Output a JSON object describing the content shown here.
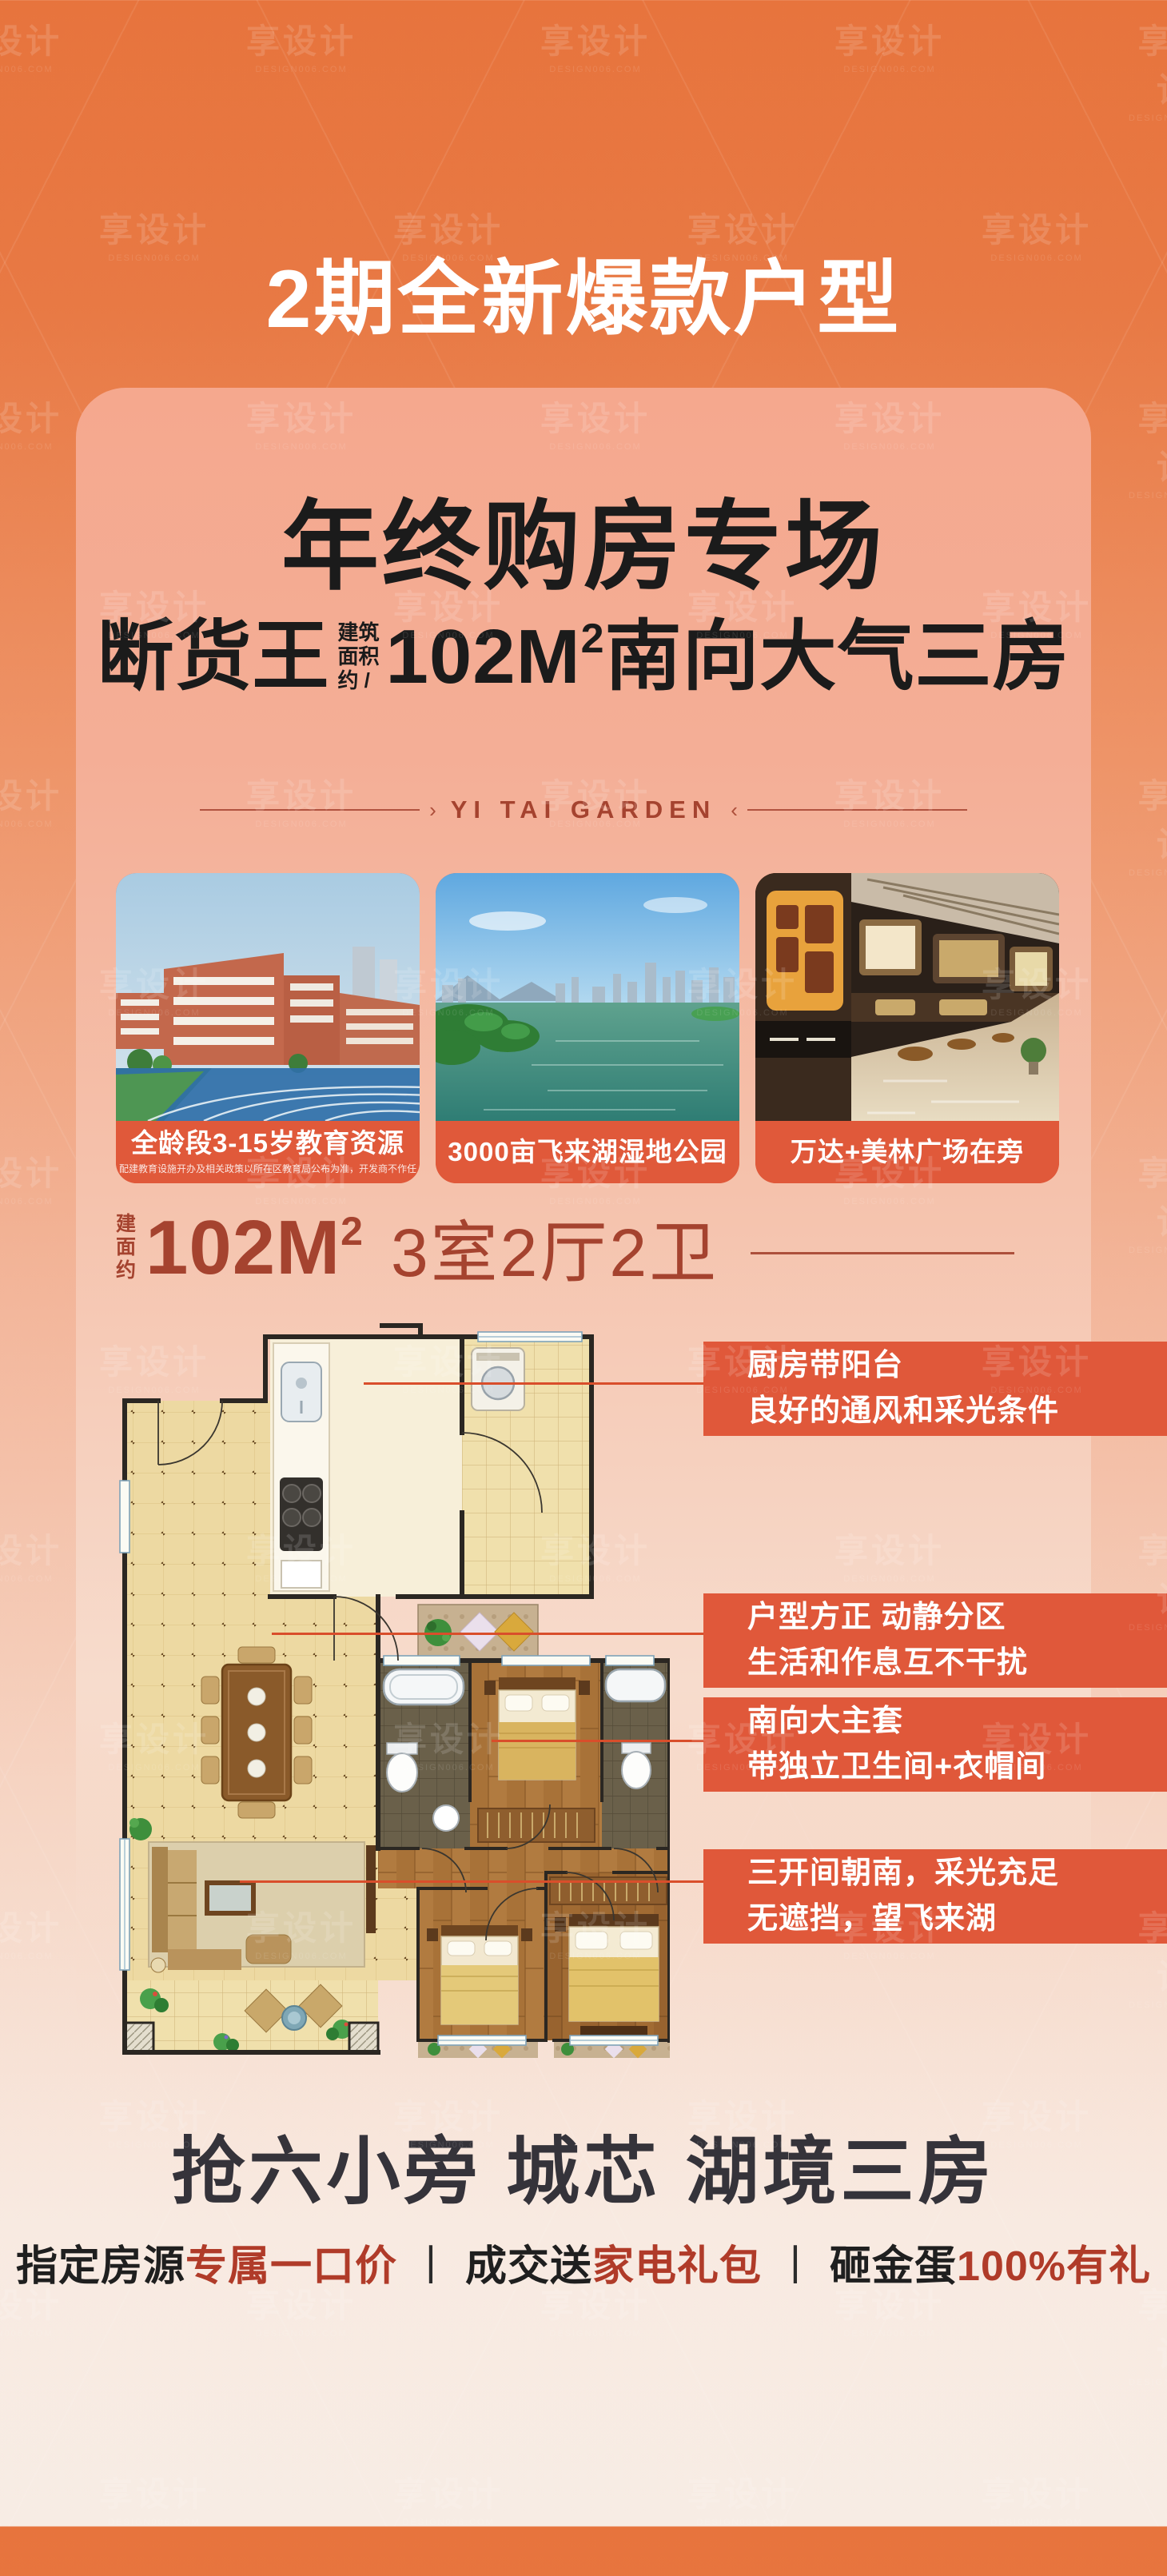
{
  "watermark": {
    "brand": "享设计",
    "site": "DESIGN006.COM"
  },
  "header": {
    "title": "2期全新爆款户型"
  },
  "card": {
    "headline": "年终购房专场",
    "sub": {
      "prefix": "断货王",
      "note1": "建筑",
      "note2": "面积",
      "note3": "约 /",
      "area": "102M",
      "sup": "2",
      "suffix": "南向大气三房"
    },
    "garden": "YI TAI GARDEN",
    "garden_arrow_right": "›",
    "garden_arrow_left": "‹"
  },
  "photos": [
    {
      "caption": "全龄段3-15岁教育资源",
      "note": "配建教育设施开办及相关政策以所在区教育局公布为准，开发商不作任何承诺"
    },
    {
      "caption": "3000亩飞来湖湿地公园"
    },
    {
      "caption": "万达+美林广场在旁"
    }
  ],
  "spec": {
    "l1": "建",
    "l2": "面",
    "l3": "约",
    "area": "102M",
    "sup": "2",
    "rooms": "3室2厅2卫"
  },
  "callouts": [
    {
      "line1": "厨房带阳台",
      "line2": "良好的通风和采光条件"
    },
    {
      "line1": "户型方正 动静分区",
      "line2": "生活和作息互不干扰"
    },
    {
      "line1": "南向大主套",
      "line2": "带独立卫生间+衣帽间"
    },
    {
      "line1": "三开间朝南，采光充足",
      "line2": "无遮挡，望飞来湖"
    }
  ],
  "footer": {
    "headline": "抢六小旁 城芯 湖境三房",
    "separator": "丨",
    "offers": [
      {
        "plain": "指定房源",
        "highlight": "专属一口价"
      },
      {
        "plain": "成交送",
        "highlight": "家电礼包"
      },
      {
        "plain": "砸金蛋",
        "highlight": "100%有礼"
      }
    ]
  },
  "colors": {
    "accent_orange": "#E0583A",
    "deep_red": "#A5432F",
    "highlight_red": "#B03B29",
    "card_salmon": "#F4A78E",
    "background_top": "#E7743D"
  }
}
